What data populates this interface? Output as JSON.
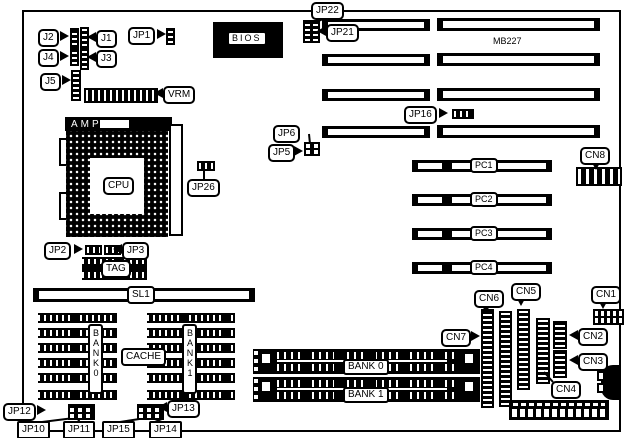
{
  "board": {
    "model": "MB227",
    "kind": "motherboard jumper and connector diagram"
  },
  "labels": {
    "j1": "J1",
    "j2": "J2",
    "j3": "J3",
    "j4": "J4",
    "j5": "J5",
    "jp1": "JP1",
    "jp2": "JP2",
    "jp3": "JP3",
    "jp5": "JP5",
    "jp6": "JP6",
    "jp10": "JP10",
    "jp11": "JP11",
    "jp12": "JP12",
    "jp13": "JP13",
    "jp14": "JP14",
    "jp15": "JP15",
    "jp16": "JP16",
    "jp21": "JP21",
    "jp22": "JP22",
    "jp26": "JP26",
    "bios": "BIOS",
    "vrm": "VRM",
    "amp": "AMP",
    "cpu": "CPU",
    "tag": "TAG",
    "sl1": "SL1",
    "cache": "CACHE",
    "cache_bank_0": "BANK0",
    "cache_bank_1": "BANK1",
    "pc1": "PC1",
    "pc2": "PC2",
    "pc3": "PC3",
    "pc4": "PC4",
    "cn1": "CN1",
    "cn2": "CN2",
    "cn3": "CN3",
    "cn4": "CN4",
    "cn5": "CN5",
    "cn6": "CN6",
    "cn7": "CN7",
    "cn8": "CN8",
    "simm_bank_0": "BANK 0",
    "simm_bank_1": "BANK 1",
    "model": "MB227"
  }
}
